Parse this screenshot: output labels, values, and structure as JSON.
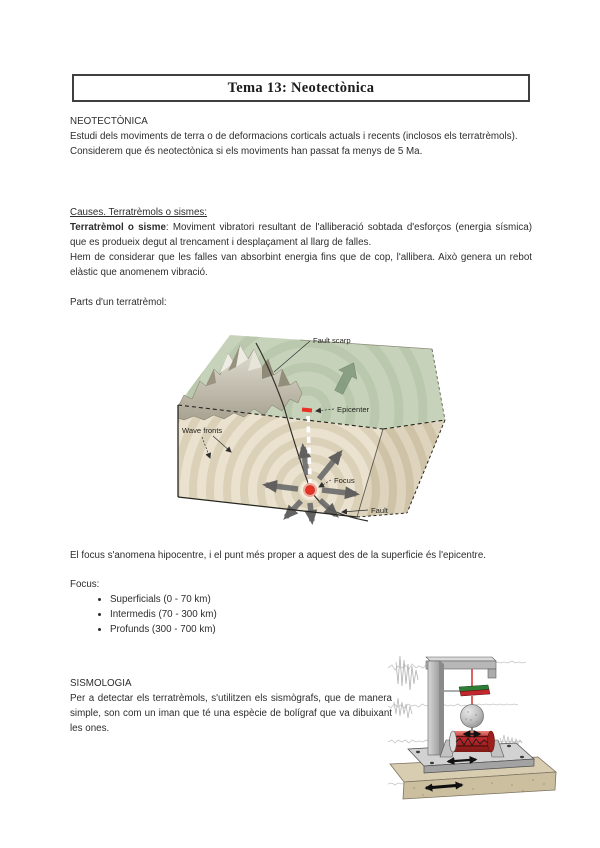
{
  "title_box": {
    "title": "Tema 13: Neotectònica"
  },
  "neotectonica": {
    "heading": "NEOTECTÒNICA",
    "para1": "Estudi dels moviments de terra o de deformacions corticals actuals i recents (inclosos els terratrèmols).",
    "para2": "Considerem que és neotectònica si els moviments han passat fa menys de 5 Ma."
  },
  "causes": {
    "heading": "Causes. Terratrèmols o sismes:",
    "term": "Terratrèmol o sisme",
    "definition": ": Moviment vibratori resultant de l'alliberació sobtada d'esforços (energia sísmica) que es produeix degut al trencament i desplaçament al llarg de falles.",
    "para2": "Hem de considerar que les falles van absorbint energia fins que de cop, l'allibera. Això genera un rebot elàstic que anomenem vibració.",
    "parts_label": "Parts d'un terratrèmol:"
  },
  "earthquake_diagram": {
    "labels": {
      "fault_scarp": "Fault scarp",
      "epicenter": "Epicenter",
      "wave_fronts": "Wave fronts",
      "focus": "Focus",
      "fault": "Fault"
    }
  },
  "focus_section": {
    "para": "El focus s'anomena hipocentre, i el punt més proper a aquest des de la superficie és l'epicentre.",
    "list_label": "Focus:",
    "items": [
      "Superficials (0 - 70 km)",
      "Intermedis (70 - 300 km)",
      "Profunds (300 - 700 km)"
    ]
  },
  "sismologia": {
    "heading": "SISMOLOGIA",
    "para": "Per a detectar els terratrèmols, s'utilitzen els sismògrafs, que de manera simple, son com un iman que té una espècie de bolígraf que va dibuixant les ones."
  },
  "colors": {
    "focus_red": "#e63325",
    "surface_green": "#c6d3ba",
    "block_beige": "#eae2cf",
    "ring_shade": "#dbd1b8",
    "arrow_gray": "#6d6d6d",
    "drum_red": "#c1272d",
    "magnet_green": "#2e7d36",
    "magnet_red": "#c1272d",
    "frame_gray": "#b7b7b7",
    "ground_tan": "#d8cdb0"
  }
}
